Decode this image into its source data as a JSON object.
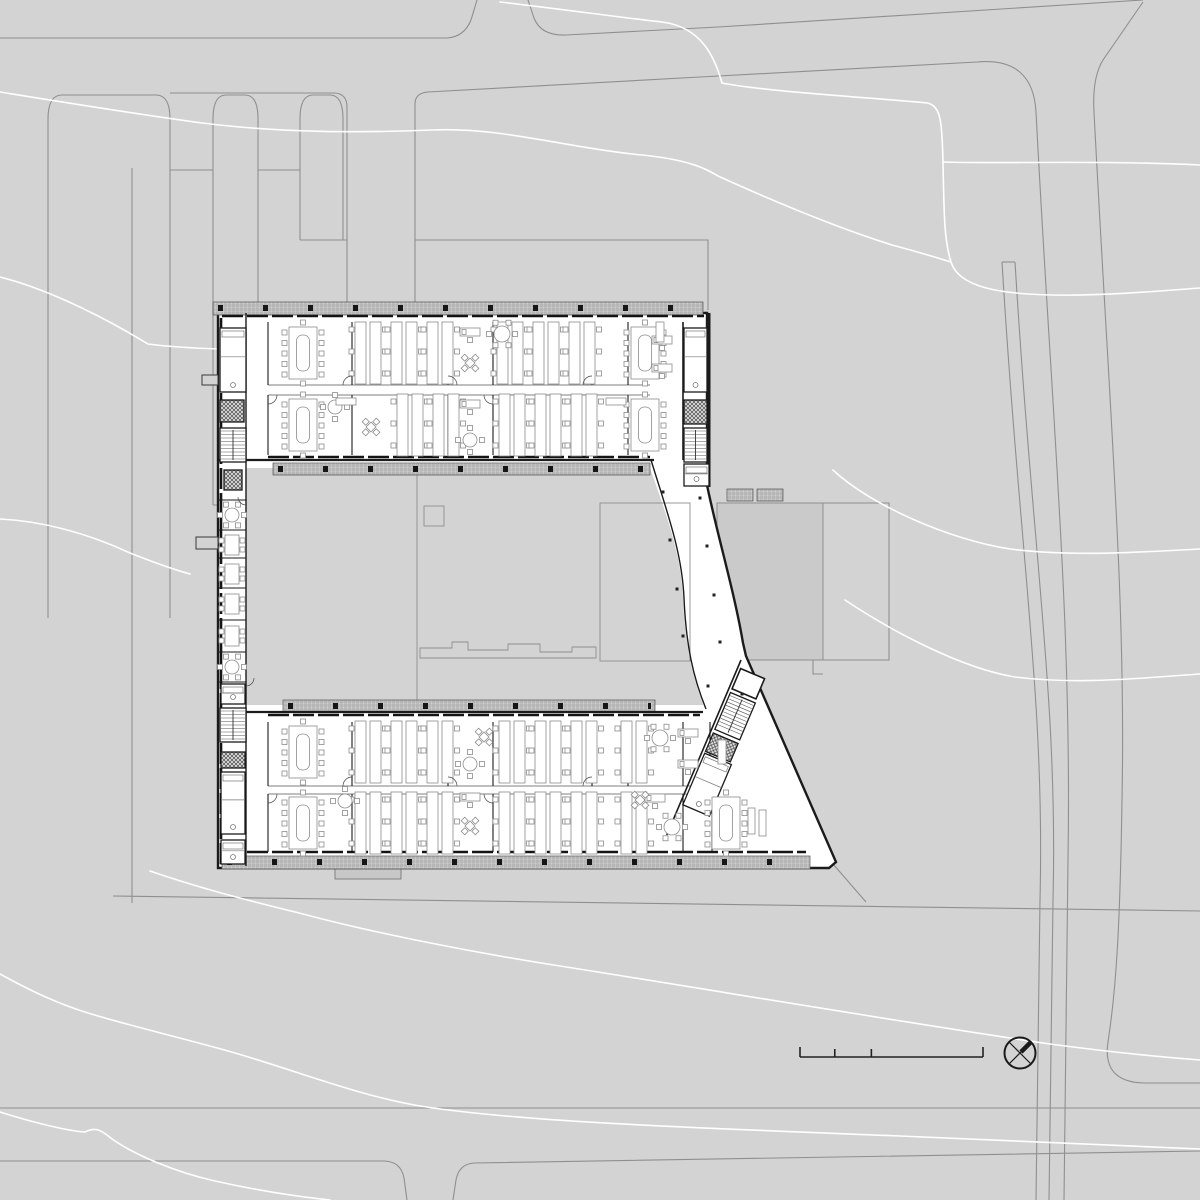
{
  "meta": {
    "drawing_type": "architectural-site-floor-plan",
    "canvas": {
      "w": 1200,
      "h": 1200
    }
  },
  "palette": {
    "site_bg": "#d3d3d3",
    "road_line": "#8f8f8f",
    "contour_line": "#ffffff",
    "building_fill": "#ffffff",
    "wall": "#1b1b1b",
    "thin_line": "#6f6f6f",
    "furniture_line": "#8c8c8c",
    "adjacent_block_fill": "#cacaca",
    "band_fill": "#cfcfcf",
    "band_line": "#9b9b9b",
    "symbol": "#1a1a1a"
  },
  "site": {
    "roads": [
      "M0,38 H447",
      "M447,38 Q464,37 471,20 L477,0",
      "M528,0 L534,18 Q541,36 566,35 L718,27 L1143,0",
      "M170,93 H335 Q347,94 347,107 V310",
      "M48,618 V119 Q48,95 62,95 H156 Q170,95 170,119 V618",
      "M213,505 V119 Q213,95 226,95 H245 Q258,95 258,119 V505",
      "M300,240 V119 Q300,95 313,95 H330 Q343,95 343,119 V240",
      "M170,170 H213",
      "M258,170 H300",
      "M213,505 H258",
      "M300,240 H347",
      "M132,168 V903",
      "M415,310 V104 Q415,93 428,92 L700,77 L977,62 Q1033,57 1036,112 C1052,420 1072,620 1068,860 L1064,1200",
      "M1143,2 L1103,60 Q1092,78 1094,112 C1110,420 1126,600 1122,800 C1120,930 1116,990 1108,1042 Q1102,1082 1144,1083 L1200,1083",
      "M1002,262 C1020,560 1045,700 1040,900 L1036,1200",
      "M1015,262 C1033,560 1058,700 1053,900 L1049,1200",
      "M1002,262 H1015",
      "M0,1108 H1200",
      "M0,1161 H385 Q401,1162 404,1178 L407,1200",
      "M453,1200 L456,1180 Q459,1164 474,1163 L1200,1151",
      "M113,896 L1200,911",
      "M833,864 L866,902",
      "M415,240 H708 V310",
      "M823,503 H889 V660 H823",
      "M813,660 V674 H823"
    ],
    "contours": [
      "M500,2 C560,9 625,18 662,22 C702,27 715,58 722,83 C762,91 862,97 928,103 C941,107 942,122 943,162 C944,212 944,240 951,262 C959,288 1002,294 1052,295 C1102,296 1160,291 1200,288",
      "M943,162 C995,164 1090,160 1200,165",
      "M0,92 C62,102 142,115 202,123 C282,133 362,133 432,130 C502,127 562,147 642,155 C692,160 708,170 718,176 C762,196 832,226 892,245 C922,253 938,258 951,262",
      "M0,277 C40,287 92,310 148,344 C210,352 300,349 392,351 C432,362 460,386 497,409",
      "M0,519 C40,521 85,532 130,553 C158,564 175,570 190,574",
      "M833,470 C870,505 950,540 1010,549 C1075,557 1140,552 1200,549",
      "M845,600 C890,630 960,668 1015,677 C1080,685 1140,678 1200,674",
      "M150,871 C205,890 255,902 303,914 C370,932 470,952 560,966 C700,988 900,1022 1050,1044 C1110,1052 1160,1057 1200,1060",
      "M0,974 C25,988 55,1003 88,1013 C130,1026 190,1040 235,1053 C300,1072 360,1096 420,1106 C520,1122 700,1128 900,1136 C1030,1141 1130,1146 1200,1149",
      "M0,1112 C35,1123 68,1131 85,1132 C95,1127 100,1129 112,1139 C135,1155 175,1172 215,1181 C260,1191 300,1197 330,1200"
    ],
    "adjacent_block": {
      "x": 717,
      "y": 503,
      "w": 106,
      "h": 157
    }
  },
  "building": {
    "outer_path": "M218,313 H707 V485 C717,534 734,590 743,643 L746,656 L836,862 L829,868 L218,868 Z",
    "courtyard_path": "M246,468 H650 C666,514 681,553 683,598 C685,644 692,674 703,704 L703,705 L246,705 Z",
    "atrium_inner_path": "M651,460 C667,512 682,552 684,598 C686,645 693,677 706,709",
    "extension": [
      335,
      869,
      66,
      10
    ],
    "stubs": [
      [
        202,
        375,
        16,
        10
      ],
      [
        196,
        537,
        22,
        12
      ]
    ],
    "bands": [
      [
        213,
        302,
        490,
        13
      ],
      [
        273,
        463,
        377,
        12
      ],
      [
        283,
        700,
        372,
        12
      ],
      [
        222,
        856,
        588,
        13
      ],
      [
        727,
        489,
        26,
        12
      ],
      [
        757,
        489,
        26,
        12
      ]
    ],
    "band_ticks": [
      "M218,308 H700",
      "M278,469 H646",
      "M288,706 H651",
      "M227,862 H806"
    ],
    "mullions": [
      "M222,316 H704",
      "M268,457 H650",
      "M268,715 H700",
      "M222,852 H806",
      "M221,318 V864"
    ],
    "walls": [
      [
        246,
        313,
        246,
        866,
        1.4
      ],
      [
        218,
        460,
        654,
        460,
        2.2
      ],
      [
        246,
        712,
        703,
        712,
        2.2
      ],
      [
        683,
        322,
        683,
        460,
        1.6
      ],
      [
        709,
        313,
        709,
        487,
        3
      ]
    ],
    "corridors": [
      [
        268,
        385,
        650,
        385
      ],
      [
        268,
        395,
        650,
        395
      ],
      [
        268,
        786,
        700,
        786
      ],
      [
        268,
        794,
        700,
        794
      ]
    ],
    "partitions": [
      [
        268,
        322,
        268,
        385
      ],
      [
        352,
        322,
        352,
        385
      ],
      [
        448,
        322,
        448,
        385
      ],
      [
        493,
        322,
        493,
        385
      ],
      [
        592,
        322,
        592,
        385
      ],
      [
        628,
        322,
        628,
        385
      ],
      [
        268,
        395,
        268,
        455
      ],
      [
        352,
        395,
        352,
        455
      ],
      [
        448,
        395,
        448,
        455
      ],
      [
        493,
        395,
        493,
        455
      ],
      [
        592,
        395,
        592,
        455
      ],
      [
        628,
        395,
        628,
        455
      ],
      [
        268,
        722,
        268,
        786
      ],
      [
        352,
        722,
        352,
        786
      ],
      [
        448,
        722,
        448,
        786
      ],
      [
        493,
        722,
        493,
        786
      ],
      [
        592,
        722,
        592,
        786
      ],
      [
        628,
        722,
        628,
        786
      ],
      [
        683,
        722,
        683,
        786
      ],
      [
        710,
        722,
        710,
        786
      ],
      [
        268,
        794,
        268,
        852
      ],
      [
        352,
        794,
        352,
        852
      ],
      [
        448,
        794,
        448,
        852
      ],
      [
        493,
        794,
        493,
        852
      ],
      [
        592,
        794,
        592,
        852
      ],
      [
        628,
        794,
        628,
        852
      ],
      [
        683,
        794,
        683,
        852
      ],
      [
        712,
        794,
        712,
        852
      ],
      [
        218,
        500,
        246,
        500
      ],
      [
        218,
        530,
        246,
        530
      ],
      [
        218,
        558,
        246,
        558
      ],
      [
        218,
        588,
        246,
        588
      ],
      [
        218,
        620,
        246,
        620
      ],
      [
        218,
        652,
        246,
        652
      ],
      [
        218,
        682,
        246,
        682
      ]
    ],
    "conference_tables": [
      [
        303,
        353
      ],
      [
        645,
        353
      ],
      [
        303,
        425
      ],
      [
        645,
        425
      ],
      [
        303,
        752
      ],
      [
        303,
        823
      ],
      [
        726,
        823
      ]
    ],
    "bench_clusters": [
      [
        368,
        353
      ],
      [
        404,
        353
      ],
      [
        440,
        353
      ],
      [
        510,
        353
      ],
      [
        546,
        353
      ],
      [
        582,
        353
      ],
      [
        410,
        425
      ],
      [
        446,
        425
      ],
      [
        512,
        425
      ],
      [
        548,
        425
      ],
      [
        584,
        425
      ],
      [
        368,
        752
      ],
      [
        404,
        752
      ],
      [
        440,
        752
      ],
      [
        512,
        752
      ],
      [
        548,
        752
      ],
      [
        584,
        752
      ],
      [
        634,
        752
      ],
      [
        368,
        823
      ],
      [
        404,
        823
      ],
      [
        440,
        823
      ],
      [
        512,
        823
      ],
      [
        548,
        823
      ],
      [
        584,
        823
      ],
      [
        634,
        823
      ]
    ],
    "round_tables": [
      [
        502,
        334,
        8,
        6
      ],
      [
        335,
        407,
        7,
        4
      ],
      [
        470,
        440,
        7,
        4
      ],
      [
        660,
        738,
        8,
        6
      ],
      [
        470,
        764,
        7,
        4
      ],
      [
        672,
        827,
        8,
        6
      ],
      [
        345,
        801,
        7,
        4
      ],
      [
        232,
        515,
        7,
        6
      ],
      [
        232,
        667,
        7,
        6
      ]
    ],
    "desks": [
      [
        470,
        332
      ],
      [
        470,
        404
      ],
      [
        662,
        340
      ],
      [
        662,
        368
      ],
      [
        688,
        733
      ],
      [
        688,
        764
      ],
      [
        470,
        797
      ],
      [
        655,
        798
      ]
    ],
    "x_tables": [
      [
        470,
        363
      ],
      [
        371,
        427
      ],
      [
        484,
        737
      ],
      [
        470,
        826
      ],
      [
        640,
        800
      ]
    ],
    "cabinets": [
      [
        656,
        322,
        8,
        20
      ],
      [
        718,
        740,
        8,
        24
      ],
      [
        748,
        808,
        7,
        26
      ],
      [
        759,
        810,
        7,
        26
      ],
      [
        336,
        398,
        20,
        7
      ],
      [
        606,
        398,
        20,
        7
      ]
    ],
    "west_tables": [
      [
        232,
        545
      ],
      [
        232,
        574
      ],
      [
        232,
        604
      ],
      [
        232,
        636
      ]
    ],
    "stairs": [
      [
        220,
        428,
        26,
        34
      ],
      [
        684,
        428,
        23,
        34
      ],
      [
        220,
        708,
        26,
        34
      ]
    ],
    "elevators": [
      [
        220,
        400,
        24,
        22
      ],
      [
        684,
        400,
        23,
        24
      ],
      [
        224,
        470,
        18,
        20
      ],
      [
        221,
        752,
        24,
        16
      ]
    ],
    "wc_rooms": [
      [
        220,
        328,
        26,
        64
      ],
      [
        684,
        328,
        23,
        64
      ],
      [
        221,
        772,
        24,
        62
      ],
      [
        221,
        840,
        24,
        24
      ],
      [
        221,
        684,
        24,
        20
      ],
      [
        684,
        464,
        25,
        22
      ]
    ],
    "columns": [
      [
        663,
        492
      ],
      [
        700,
        498
      ],
      [
        670,
        540
      ],
      [
        707,
        546
      ],
      [
        677,
        589
      ],
      [
        714,
        595
      ],
      [
        683,
        636
      ],
      [
        720,
        642
      ],
      [
        708,
        686
      ],
      [
        742,
        694
      ]
    ],
    "court_lines": {
      "vert": "M417,468 V702",
      "square": [
        424,
        506,
        20,
        20
      ],
      "steps": "M420,648 H452 V642 H468 V650 H508 V644 H540 V652 H572 V647 H596 V658 H420 Z",
      "rect": [
        600,
        503,
        90,
        158
      ]
    },
    "doors": [
      [
        352,
        385,
        9,
        1
      ],
      [
        448,
        385,
        9,
        2
      ],
      [
        592,
        385,
        9,
        1
      ],
      [
        493,
        395,
        9,
        3
      ],
      [
        268,
        395,
        9,
        4
      ],
      [
        352,
        786,
        9,
        1
      ],
      [
        448,
        786,
        9,
        2
      ],
      [
        592,
        786,
        9,
        1
      ],
      [
        493,
        794,
        9,
        3
      ],
      [
        268,
        794,
        9,
        4
      ],
      [
        246,
        497,
        8,
        3
      ],
      [
        246,
        678,
        8,
        4
      ]
    ],
    "se_core": {
      "tx": 741,
      "ty": 660,
      "rot": 23,
      "room": [
        3,
        8,
        26,
        22
      ],
      "stair": [
        3,
        34,
        27,
        40
      ],
      "elev": [
        3,
        78,
        27,
        20
      ],
      "wc": [
        3,
        100,
        29,
        56
      ]
    }
  },
  "symbols": {
    "north_arrow": {
      "cx": 1020,
      "cy": 1053,
      "r": 15.5
    },
    "scale_bar": {
      "x": 800,
      "y": 1057,
      "len": 183,
      "ticks": [
        [
          0,
          10
        ],
        [
          0.19,
          8
        ],
        [
          0.39,
          8
        ],
        [
          1,
          10
        ]
      ]
    }
  }
}
